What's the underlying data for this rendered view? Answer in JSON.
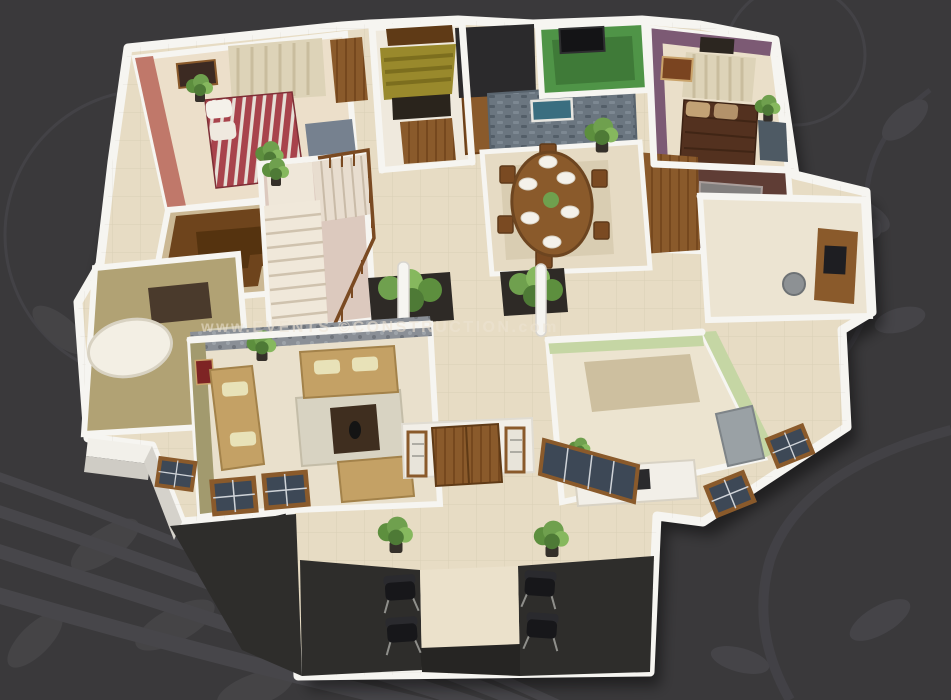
{
  "watermark": {
    "text": "www.EVENTS ©CONSTRUCTION.com"
  },
  "scene": {
    "type": "3d-floor-plan-render",
    "view": "aerial-dollhouse",
    "background_decor": [
      "floral-swirl-circle",
      "leaf-cluster-bottom-left",
      "leaf-vine-right",
      "butterfly",
      "curved-stripes-bottom-left"
    ]
  },
  "palette": {
    "background": "#3a393b",
    "decor_line": "#4a494c",
    "floor": "#e7dcc4",
    "wall_white": "#f6f5f1",
    "wall_side": "#d5d2cb",
    "charcoal": "#2e2d2b",
    "salmon": "#c0786a",
    "bed_red": "#a8434c",
    "mauve": "#7c5a74",
    "terrace_green": "#4f9447",
    "stone": "#6b7680",
    "olive": "#a29a6e",
    "bath_olive": "#b1a274",
    "wood": "#8a5a2b",
    "wood_dark": "#6e441c",
    "sofa_tan": "#c4a165",
    "kitchen_green": "#c5d6a4",
    "glass_blue": "#3d4856",
    "plant_green": "#6fa04e",
    "fridge_gray": "#9aa1a5",
    "watermark_color": "#eee4d4"
  },
  "rooms": [
    {
      "name": "bedroom-1",
      "wall": "salmon-pink",
      "features": "double bed with red striped bedding, white pillows, wardrobe, slate rug, curtained window, two potted plants, wall art"
    },
    {
      "name": "walk-in-closet",
      "wall": "white",
      "features": "U-shaped dark wooden wardrobe"
    },
    {
      "name": "bathroom-1",
      "wall": "olive-tan",
      "features": "white tub, dark vanity, glass shower partition"
    },
    {
      "name": "staircase",
      "wall": "white",
      "features": "L-shaped stair with landing and wooden railing, corner plant"
    },
    {
      "name": "foyer",
      "wall": "white",
      "features": "olive awning, wooden double door, cabinet"
    },
    {
      "name": "dining-room",
      "wall": "stone-feature",
      "features": "oval 6-seat wooden dining table with white place settings, stone accent wall with seascape picture, tall plant"
    },
    {
      "name": "terrace",
      "floor": "green",
      "features": "wall mounted TV"
    },
    {
      "name": "bedroom-2",
      "wall": "mauve-purple",
      "features": "double bed with dark brown bedding, tan pillows, beige curtains, wall art, plant"
    },
    {
      "name": "bathroom-2",
      "floor": "dark-maroon",
      "features": "glass shower cubicle, cream tub"
    },
    {
      "name": "study",
      "wall": "white",
      "features": "desk with monitor, office chair"
    },
    {
      "name": "living-room",
      "wall": "olive + pebble-stone band",
      "features": "three tan sofas with cream cushions, dark coffee table on pale rug, plant, dark framed windows"
    },
    {
      "name": "kitchen",
      "wall": "pale-green",
      "features": "white counter with dark cooktop and sink, gray refrigerator, framed windows"
    },
    {
      "name": "entrance-porch",
      "floor": "cream + charcoal platforms",
      "features": "four black chairs, two potted plants, central walkway, charcoal steps"
    }
  ]
}
